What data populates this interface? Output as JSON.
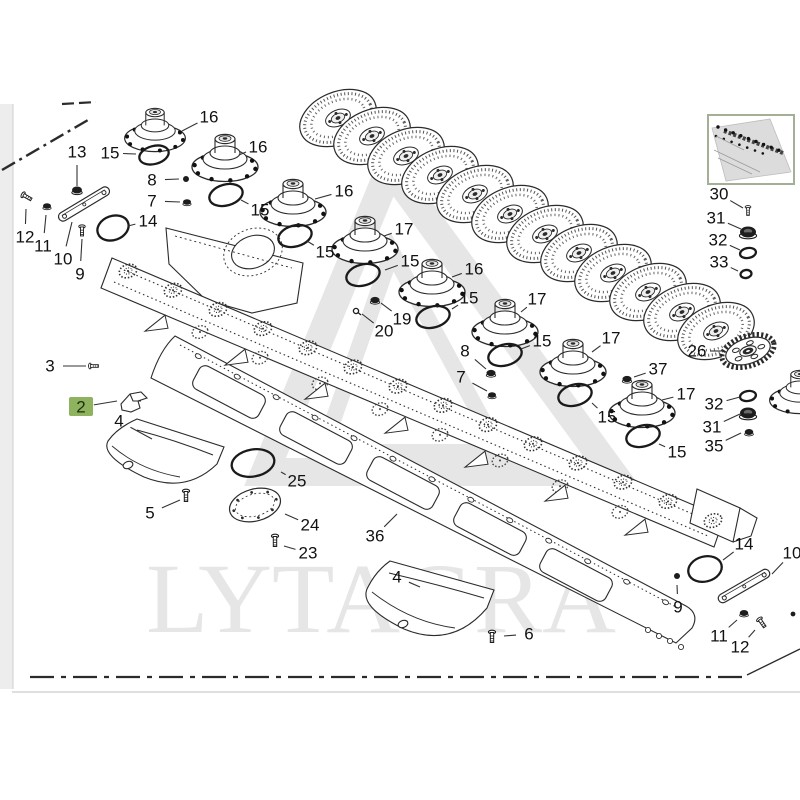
{
  "watermark": {
    "text": "LYTAGRA"
  },
  "colors": {
    "ink": "#2b2b2b",
    "label": "#111111",
    "leader": "#333333",
    "highlight": "#8fb25f",
    "highlight_text": "#1c2e10",
    "watermark": "#e6e6e6",
    "thumb_border": "#a3b096",
    "page_edge": "#ededed",
    "separator": "#cccccc"
  },
  "selected_part": {
    "number": "2"
  },
  "diagram": {
    "discs": [
      [
        338,
        118
      ],
      [
        372,
        136
      ],
      [
        406,
        156
      ],
      [
        440,
        175
      ],
      [
        475,
        194
      ],
      [
        510,
        214
      ],
      [
        545,
        234
      ],
      [
        579,
        253
      ],
      [
        613,
        273
      ],
      [
        648,
        292
      ],
      [
        682,
        312
      ],
      [
        716,
        331
      ]
    ],
    "hubs": [
      [
        155,
        130,
        0.92
      ],
      [
        225,
        158,
        1
      ],
      [
        293,
        203,
        1
      ],
      [
        365,
        240,
        1
      ],
      [
        432,
        283,
        1
      ],
      [
        505,
        323,
        1
      ],
      [
        573,
        363,
        1
      ],
      [
        642,
        404,
        1
      ],
      [
        800,
        392,
        0.92
      ]
    ],
    "gear": [
      748,
      351
    ],
    "orings": [
      [
        154,
        155,
        15,
        9,
        -15
      ],
      [
        226,
        195,
        17,
        10.5,
        -15
      ],
      [
        295,
        236,
        17,
        10.5,
        -15
      ],
      [
        363,
        275,
        17,
        10.5,
        -15
      ],
      [
        433,
        317,
        17,
        10.5,
        -15
      ],
      [
        505,
        355,
        17,
        10.5,
        -15
      ],
      [
        575,
        395,
        17,
        10.5,
        -15
      ],
      [
        643,
        436,
        17,
        10.5,
        -15
      ],
      [
        113,
        228,
        16,
        12,
        -20
      ],
      [
        705,
        569,
        17,
        12.5,
        -15
      ],
      [
        253,
        463,
        21.5,
        13.5,
        -10
      ],
      [
        748,
        253,
        8,
        5,
        -10
      ],
      [
        746,
        274,
        5.5,
        4,
        -10
      ],
      [
        748,
        396,
        8,
        5,
        -10
      ]
    ],
    "bars": [
      [
        84,
        204,
        58,
        -31
      ],
      [
        744,
        586,
        58,
        -30
      ]
    ],
    "fasteners": [
      [
        "nut",
        77,
        190,
        1,
        0
      ],
      [
        "dot",
        186,
        179,
        1,
        0
      ],
      [
        "nut",
        187,
        202,
        0.8,
        0
      ],
      [
        "screw",
        27,
        197,
        0.9,
        -60
      ],
      [
        "nut",
        47,
        206,
        0.8,
        0
      ],
      [
        "screw",
        82,
        231,
        0.9,
        0
      ],
      [
        "screw",
        94,
        366,
        0.8,
        -90
      ],
      [
        "screw",
        186,
        496,
        1,
        0
      ],
      [
        "nut",
        375,
        300,
        0.9,
        0
      ],
      [
        "pin",
        356,
        311,
        1,
        0
      ],
      [
        "nut",
        491,
        373,
        0.9,
        0
      ],
      [
        "nut",
        492,
        395,
        0.8,
        0
      ],
      [
        "nut",
        627,
        379,
        0.9,
        0
      ],
      [
        "screw",
        748,
        211,
        0.8,
        0
      ],
      [
        "cap",
        748,
        232,
        1,
        0
      ],
      [
        "cap",
        748,
        413,
        1,
        0
      ],
      [
        "nut",
        749,
        432,
        0.85,
        0
      ],
      [
        "screw",
        275,
        541,
        1,
        0
      ],
      [
        "screw",
        492,
        637,
        1,
        0
      ],
      [
        "dot",
        677,
        576,
        1,
        0
      ],
      [
        "nut",
        744,
        613,
        0.85,
        0
      ],
      [
        "screw",
        762,
        623,
        0.9,
        -35
      ],
      [
        "dot",
        793,
        614,
        0.8,
        0
      ]
    ],
    "plate24": [
      255,
      505
    ],
    "callouts": [
      {
        "n": "13",
        "tx": 77,
        "ty": 152,
        "px": 77,
        "py": 186
      },
      {
        "n": "15",
        "tx": 110,
        "ty": 153,
        "px": 136,
        "py": 154
      },
      {
        "n": "16",
        "tx": 209,
        "ty": 117,
        "px": 182,
        "py": 131
      },
      {
        "n": "8",
        "tx": 152,
        "ty": 180,
        "px": 179,
        "py": 179
      },
      {
        "n": "7",
        "tx": 152,
        "ty": 201,
        "px": 180,
        "py": 202
      },
      {
        "n": "14",
        "tx": 148,
        "ty": 221,
        "px": 128,
        "py": 226
      },
      {
        "n": "12",
        "tx": 25,
        "ty": 237,
        "px": 26,
        "py": 209
      },
      {
        "n": "11",
        "tx": 43,
        "ty": 246,
        "px": 46,
        "py": 215
      },
      {
        "n": "10",
        "tx": 63,
        "ty": 259,
        "px": 72,
        "py": 222
      },
      {
        "n": "9",
        "tx": 80,
        "ty": 274,
        "px": 82,
        "py": 239
      },
      {
        "n": "3",
        "tx": 50,
        "ty": 366,
        "px": 86,
        "py": 366
      },
      {
        "n": "2",
        "tx": 81,
        "ty": 407,
        "px": 117,
        "py": 401,
        "hl": true
      },
      {
        "n": "4",
        "tx": 119,
        "ty": 421,
        "px": 152,
        "py": 439
      },
      {
        "n": "5",
        "tx": 150,
        "ty": 513,
        "px": 180,
        "py": 500
      },
      {
        "n": "16",
        "tx": 258,
        "ty": 147,
        "px": 239,
        "py": 155
      },
      {
        "n": "15",
        "tx": 260,
        "ty": 210,
        "px": 241,
        "py": 200
      },
      {
        "n": "16",
        "tx": 344,
        "ty": 191,
        "px": 315,
        "py": 199
      },
      {
        "n": "15",
        "tx": 325,
        "ty": 252,
        "px": 307,
        "py": 241
      },
      {
        "n": "17",
        "tx": 404,
        "ty": 229,
        "px": 384,
        "py": 236
      },
      {
        "n": "15",
        "tx": 410,
        "ty": 261,
        "px": 385,
        "py": 270
      },
      {
        "n": "16",
        "tx": 474,
        "ty": 269,
        "px": 452,
        "py": 277
      },
      {
        "n": "15",
        "tx": 469,
        "ty": 298,
        "px": 452,
        "py": 309
      },
      {
        "n": "19",
        "tx": 402,
        "ty": 319,
        "px": 381,
        "py": 303
      },
      {
        "n": "20",
        "tx": 384,
        "ty": 331,
        "px": 362,
        "py": 314
      },
      {
        "n": "17",
        "tx": 537,
        "ty": 299,
        "px": 521,
        "py": 312
      },
      {
        "n": "8",
        "tx": 465,
        "ty": 351,
        "px": 486,
        "py": 369
      },
      {
        "n": "7",
        "tx": 461,
        "ty": 377,
        "px": 487,
        "py": 391
      },
      {
        "n": "15",
        "tx": 542,
        "ty": 341,
        "px": 521,
        "py": 349
      },
      {
        "n": "17",
        "tx": 611,
        "ty": 338,
        "px": 592,
        "py": 352
      },
      {
        "n": "15",
        "tx": 607,
        "ty": 417,
        "px": 592,
        "py": 403
      },
      {
        "n": "37",
        "tx": 658,
        "ty": 369,
        "px": 634,
        "py": 377
      },
      {
        "n": "26",
        "tx": 697,
        "ty": 351,
        "px": 722,
        "py": 351
      },
      {
        "n": "17",
        "tx": 686,
        "ty": 394,
        "px": 662,
        "py": 400
      },
      {
        "n": "15",
        "tx": 677,
        "ty": 452,
        "px": 659,
        "py": 444
      },
      {
        "n": "25",
        "tx": 297,
        "ty": 481,
        "px": 281,
        "py": 472
      },
      {
        "n": "24",
        "tx": 310,
        "ty": 525,
        "px": 285,
        "py": 514
      },
      {
        "n": "23",
        "tx": 308,
        "ty": 553,
        "px": 284,
        "py": 546
      },
      {
        "n": "36",
        "tx": 375,
        "ty": 536,
        "px": 397,
        "py": 514
      },
      {
        "n": "4",
        "tx": 397,
        "ty": 577,
        "px": 420,
        "py": 587
      },
      {
        "n": "6",
        "tx": 529,
        "ty": 634,
        "px": 504,
        "py": 636
      },
      {
        "n": "30",
        "tx": 719,
        "ty": 194,
        "px": 743,
        "py": 208
      },
      {
        "n": "31",
        "tx": 716,
        "ty": 218,
        "px": 741,
        "py": 229
      },
      {
        "n": "32",
        "tx": 718,
        "ty": 240,
        "px": 740,
        "py": 250
      },
      {
        "n": "33",
        "tx": 719,
        "ty": 262,
        "px": 738,
        "py": 271
      },
      {
        "n": "32",
        "tx": 714,
        "ty": 404,
        "px": 740,
        "py": 397
      },
      {
        "n": "31",
        "tx": 712,
        "ty": 427,
        "px": 740,
        "py": 414
      },
      {
        "n": "35",
        "tx": 714,
        "ty": 446,
        "px": 741,
        "py": 433
      },
      {
        "n": "14",
        "tx": 744,
        "ty": 544,
        "px": 723,
        "py": 560
      },
      {
        "n": "10",
        "tx": 792,
        "ty": 553,
        "px": 772,
        "py": 574
      },
      {
        "n": "9",
        "tx": 678,
        "ty": 607,
        "px": 677,
        "py": 585
      },
      {
        "n": "11",
        "tx": 719,
        "ty": 636,
        "px": 737,
        "py": 620
      },
      {
        "n": "12",
        "tx": 740,
        "ty": 647,
        "px": 755,
        "py": 630
      }
    ]
  }
}
